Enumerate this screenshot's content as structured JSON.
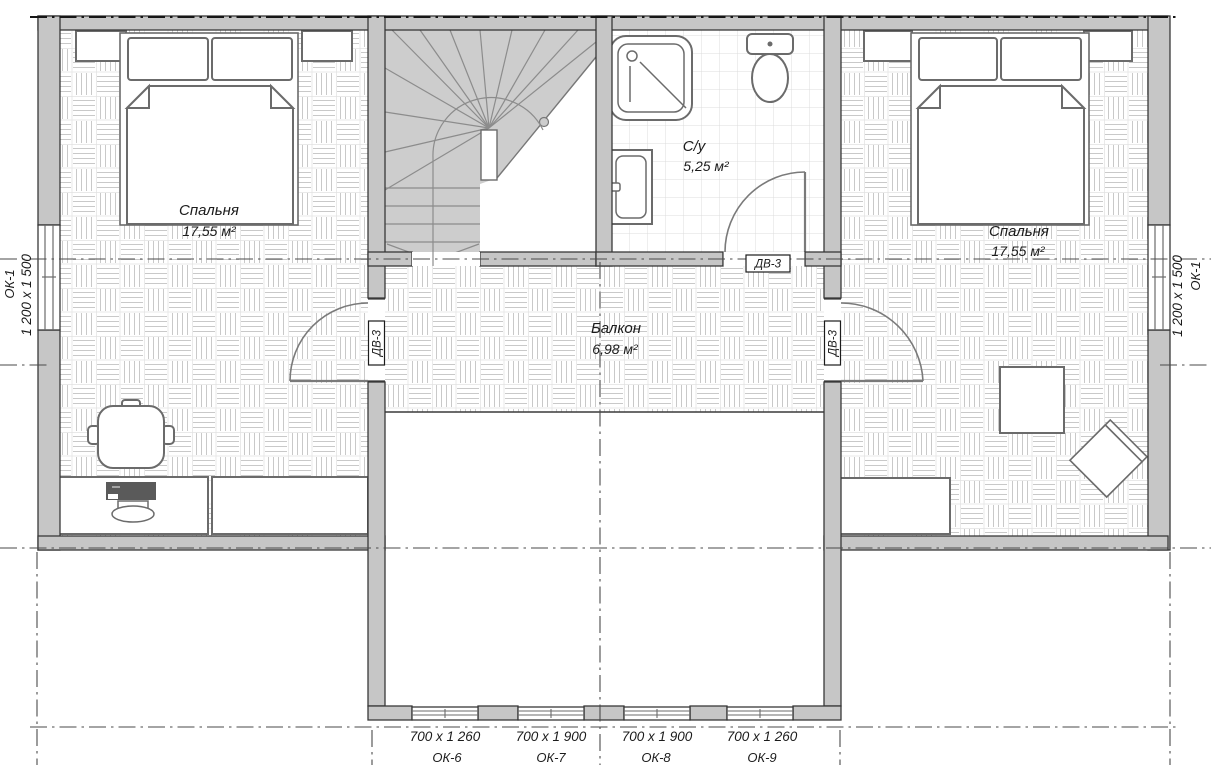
{
  "rooms": {
    "bedroom_left": {
      "name": "Спальня",
      "area": "17,55 м²"
    },
    "bedroom_right": {
      "name": "Спальня",
      "area": "17,55 м²"
    },
    "bathroom": {
      "name": "С/у",
      "area": "5,25 м²"
    },
    "balcony": {
      "name": "Балкон",
      "area": "6,98 м²"
    }
  },
  "windows": {
    "ok1_left": {
      "code": "ОК-1",
      "size": "1 200 x 1 500"
    },
    "ok1_right": {
      "code": "ОК-1",
      "size": "1 200 x 1 500"
    },
    "ok6": {
      "code": "ОК-6",
      "size": "700 x 1 260"
    },
    "ok7": {
      "code": "ОК-7",
      "size": "700 x 1 900"
    },
    "ok8": {
      "code": "ОК-8",
      "size": "700 x 1 900"
    },
    "ok9": {
      "code": "ОК-9",
      "size": "700 x 1 260"
    }
  },
  "doors": {
    "bathroom": {
      "code": "ДВ-3"
    },
    "balcony_left": {
      "code": "ДВ-3"
    },
    "balcony_right": {
      "code": "ДВ-3"
    }
  },
  "colors": {
    "wall_fill": "#c6c6c6",
    "wall_edge": "#383838",
    "furniture_line": "#6b6b6b",
    "stair_fill": "#cdcdcd",
    "stair_line": "#8c8c8c",
    "parquet_line": "#c9c9c9",
    "tile_line": "#dcdcdc",
    "axis_line": "#4a4a4a",
    "text": "#1b1b1b"
  }
}
